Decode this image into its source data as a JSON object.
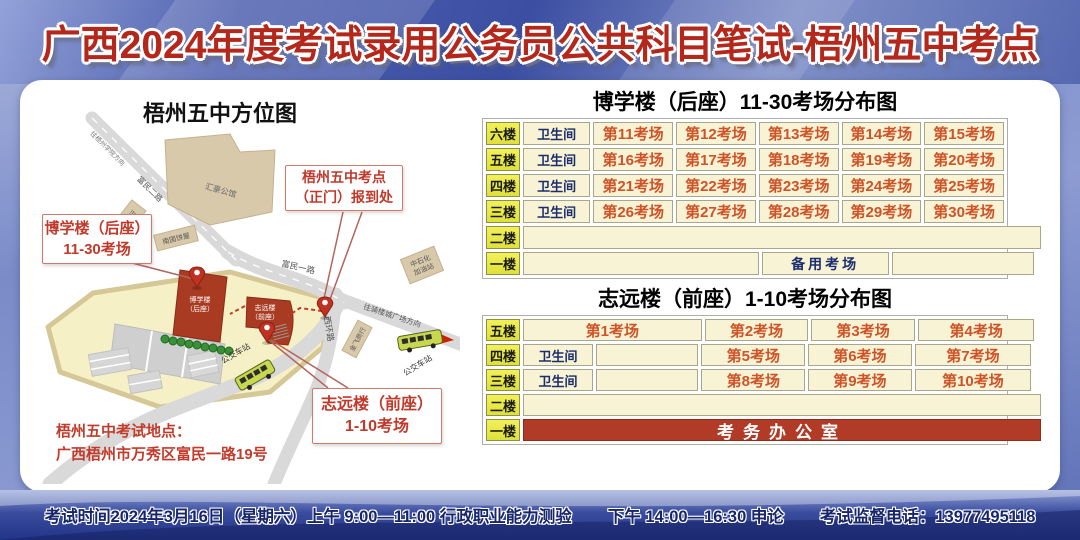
{
  "banner": {
    "title": "广西2024年度考试录用公务员公共科目笔试-梧州五中考点"
  },
  "map": {
    "title": "梧州五中方位图",
    "roads": {
      "to_university": "往梧州学院方向",
      "fumin_er": "富民二路",
      "fumin_yi": "富民一路",
      "xihuan": "西环路",
      "to_qilou": "往骑楼城广场方向"
    },
    "places": {
      "huihao": "汇豪公馆",
      "guilin_bank": "桂林银行",
      "bakery": "南国饼屋",
      "gas1": "中石化",
      "gas2": "加油站",
      "jinfei": "金飞商行",
      "bus_stop1": "公交车站",
      "bus_stop2": "公交车站"
    },
    "buildings": {
      "boxue1": "博学楼",
      "boxue2": "（后座）",
      "zhiyuan1": "志远楼",
      "zhiyuan2": "（前座）"
    },
    "callouts": {
      "gate": {
        "line1": "梧州五中考点",
        "line2": "（正门）报到处"
      },
      "boxue": {
        "line1": "博学楼（后座）",
        "line2": "11-30考场"
      },
      "zhiyuan": {
        "line1": "志远楼（前座）",
        "line2": "1-10考场"
      }
    },
    "address_title": "梧州五中考试地点：",
    "address": "广西梧州市万秀区富民一路19号"
  },
  "sections": [
    {
      "title": "博学楼（后座）11-30考场分布图",
      "rows": [
        {
          "floor": "六楼",
          "cells": [
            {
              "t": "卫生间",
              "c": "wc"
            },
            {
              "t": "第11考场",
              "c": "room"
            },
            {
              "t": "第12考场",
              "c": "room"
            },
            {
              "t": "第13考场",
              "c": "room"
            },
            {
              "t": "第14考场",
              "c": "room"
            },
            {
              "t": "第15考场",
              "c": "room"
            }
          ]
        },
        {
          "floor": "五楼",
          "cells": [
            {
              "t": "卫生间",
              "c": "wc"
            },
            {
              "t": "第16考场",
              "c": "room"
            },
            {
              "t": "第17考场",
              "c": "room"
            },
            {
              "t": "第18考场",
              "c": "room"
            },
            {
              "t": "第19考场",
              "c": "room"
            },
            {
              "t": "第20考场",
              "c": "room"
            }
          ]
        },
        {
          "floor": "四楼",
          "cells": [
            {
              "t": "卫生间",
              "c": "wc"
            },
            {
              "t": "第21考场",
              "c": "room"
            },
            {
              "t": "第22考场",
              "c": "room"
            },
            {
              "t": "第23考场",
              "c": "room"
            },
            {
              "t": "第24考场",
              "c": "room"
            },
            {
              "t": "第25考场",
              "c": "room"
            }
          ]
        },
        {
          "floor": "三楼",
          "cells": [
            {
              "t": "卫生间",
              "c": "wc"
            },
            {
              "t": "第26考场",
              "c": "room"
            },
            {
              "t": "第27考场",
              "c": "room"
            },
            {
              "t": "第28考场",
              "c": "room"
            },
            {
              "t": "第29考场",
              "c": "room"
            },
            {
              "t": "第30考场",
              "c": "room"
            }
          ]
        },
        {
          "floor": "二楼",
          "cells": [
            {
              "t": "",
              "c": "empty",
              "w": 100
            }
          ]
        },
        {
          "floor": "一楼",
          "cells": [
            {
              "t": "",
              "c": "empty",
              "w": 45.5
            },
            {
              "t": "备用考场",
              "c": "reserve",
              "w": 24.5
            },
            {
              "t": "",
              "c": "empty",
              "w": 27.5
            }
          ]
        }
      ]
    },
    {
      "title": "志远楼（前座）1-10考场分布图",
      "rows": [
        {
          "floor": "五楼",
          "cells": [
            {
              "t": "第1考场",
              "c": "room",
              "w": 34.5
            },
            {
              "t": "第2考场",
              "c": "room",
              "w": 20
            },
            {
              "t": "第3考场",
              "c": "room",
              "w": 20
            },
            {
              "t": "第4考场",
              "c": "room",
              "w": 22.5
            }
          ]
        },
        {
          "floor": "四楼",
          "cells": [
            {
              "t": "卫生间",
              "c": "wc",
              "w": 13.5
            },
            {
              "t": "",
              "c": "empty",
              "w": 19.8
            },
            {
              "t": "第5考场",
              "c": "room",
              "w": 20
            },
            {
              "t": "第6考场",
              "c": "room",
              "w": 20
            },
            {
              "t": "第7考场",
              "c": "room",
              "w": 22.5
            }
          ]
        },
        {
          "floor": "三楼",
          "cells": [
            {
              "t": "卫生间",
              "c": "wc",
              "w": 13.5
            },
            {
              "t": "",
              "c": "empty",
              "w": 19.8
            },
            {
              "t": "第8考场",
              "c": "room",
              "w": 20
            },
            {
              "t": "第9考场",
              "c": "room",
              "w": 20
            },
            {
              "t": "第10考场",
              "c": "room",
              "w": 22.5
            }
          ]
        },
        {
          "floor": "二楼",
          "cells": [
            {
              "t": "",
              "c": "empty",
              "w": 100
            }
          ]
        },
        {
          "floor": "一楼",
          "cells": [
            {
              "t": "考务办公室",
              "c": "office",
              "w": 100
            }
          ]
        }
      ]
    }
  ],
  "footer": {
    "time": "考试时间2024年3月16日（星期六）上午 9:00—11:00 行政职业能力测验",
    "afternoon": "下午 14:00—16:30 申论",
    "phone": "考试监督电话：13977495118"
  },
  "colors": {
    "title_red": "#b4271b",
    "room_text": "#cf5328",
    "navy_text": "#1c2e6e",
    "floor_yellow": "#ebe94b",
    "cell_cream": "#f7f3d4",
    "office_bg": "#b23b28",
    "building_red": "#a93b22",
    "campus": "#f6f0c6",
    "road_gray": "#d9d9d9",
    "beige": "#d9c9ab",
    "accent": "#c0392b"
  }
}
